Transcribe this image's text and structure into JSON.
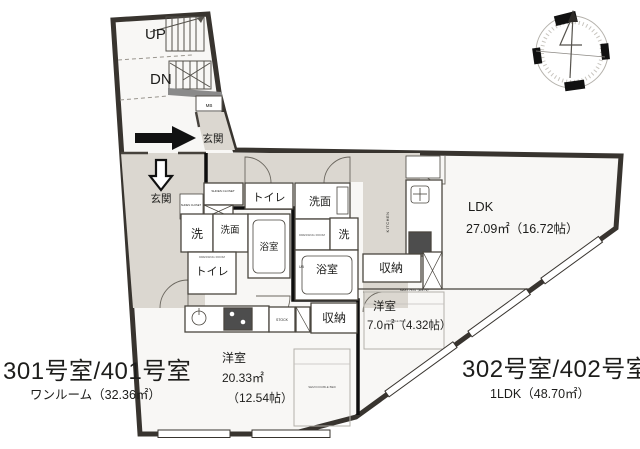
{
  "colors": {
    "wall": "#38342f",
    "shade": "#dbd7d0",
    "boundary": "#0d0d0d",
    "fixture_dark": "#4d4d4d"
  },
  "stairwell": {
    "up_label": "UP",
    "down_label": "DN",
    "meter_box_label": "MB"
  },
  "unit301": {
    "title": "301号室/401号室",
    "subtitle": "ワンルーム（32.36㎡）",
    "entrance_label": "玄関",
    "shoes_closet_label": "SHOES CLOSET",
    "shoes_closet2_label": "SHOES CLOSET",
    "washer_label": "洗",
    "washstand_label": "洗面",
    "toilet_label": "トイレ",
    "dressing_room_label": "DRESSING ROOM",
    "bath_label": "浴室",
    "stock_label": "STOCK",
    "storage_label": "収納",
    "bedroom_name": "洋室",
    "bedroom_area": "20.33㎡",
    "bedroom_size": "（12.54帖）",
    "bed_label": "SEMI DOUBLE BED"
  },
  "unit302": {
    "title": "302号室/402号室",
    "subtitle": "1LDK（48.70㎡）",
    "entrance_label": "玄関",
    "toilet_label": "トイレ",
    "washstand_label": "洗面",
    "washer_label": "洗",
    "dressing_room_label": "DRESSING ROOM",
    "bath_label": "浴室",
    "bath_ub_label": "UB",
    "kitchen_label": "KITCHEN",
    "storage_label": "収納",
    "ldk_name": "LDK",
    "ldk_area": "27.09㎡（16.72帖）",
    "bedroom_name": "洋室",
    "bedroom_area": "7.0㎡（4.32帖）",
    "bedroom_dim": "MAX7.75×4（W4.72）",
    "bed_label": "DOUBLE BED"
  }
}
